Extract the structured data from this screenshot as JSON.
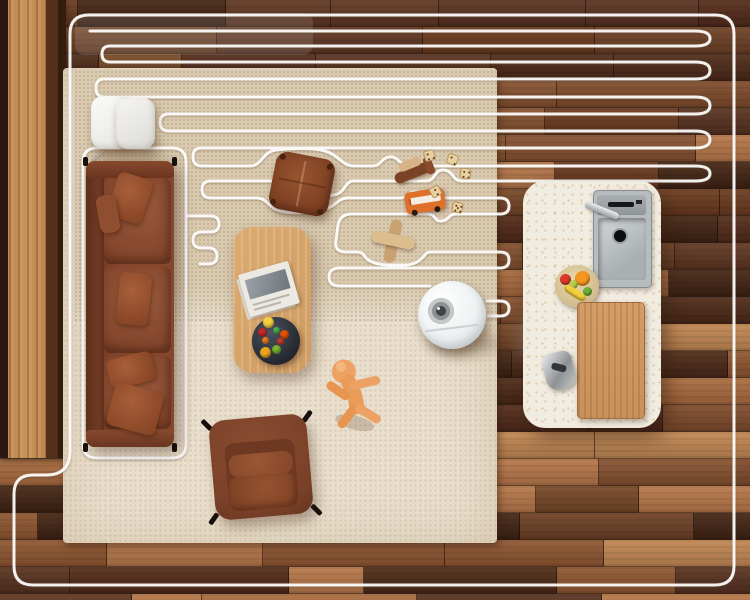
{
  "scene": {
    "type": "top-down room render",
    "description": "Robot vacuum cleaning a living room; white serpentine cleaning-path overlay covers the upper area and ends at the robot",
    "objects": [
      {
        "id": "wood-floor",
        "label": "walnut plank flooring"
      },
      {
        "id": "area-rug",
        "label": "cream area rug"
      },
      {
        "id": "inner-rug",
        "label": "beige textured rug section"
      },
      {
        "id": "cleaning-path",
        "label": "white robot cleaning path overlay"
      },
      {
        "id": "robot-vacuum",
        "label": "white robot vacuum with lidar turret"
      },
      {
        "id": "charging-dock",
        "label": "white charging dock (two units)"
      },
      {
        "id": "sofa",
        "label": "brown leather three-seat sofa with pillows"
      },
      {
        "id": "armchair",
        "label": "brown leather armchair"
      },
      {
        "id": "coffee-table",
        "label": "light wood coffee table"
      },
      {
        "id": "magazine",
        "label": "magazine on table"
      },
      {
        "id": "snack-bowl",
        "label": "dark bowl with colorful snacks"
      },
      {
        "id": "floor-pouf",
        "label": "brown leather floor cushion"
      },
      {
        "id": "kitchen-island",
        "label": "white terrazzo kitchen island"
      },
      {
        "id": "kitchen-sink",
        "label": "stainless sink with faucet"
      },
      {
        "id": "fruit-bowl",
        "label": "fruit bowl on island"
      },
      {
        "id": "cutting-board",
        "label": "wooden cutting board"
      },
      {
        "id": "utensil",
        "label": "metal kitchen utensil"
      },
      {
        "id": "toy-biplane",
        "label": "wooden toy biplane"
      },
      {
        "id": "toy-bus",
        "label": "orange toy bus"
      },
      {
        "id": "toy-plane",
        "label": "wooden toy airplane"
      },
      {
        "id": "toy-dice",
        "label": "wooden dice"
      },
      {
        "id": "toy-figure",
        "label": "orange toy figure"
      }
    ],
    "robot": {
      "center_x": 452,
      "center_y": 315,
      "diameter": 68
    },
    "dice": [
      {
        "x": 424,
        "y": 150,
        "rot": -15,
        "pips": [
          [
            3,
            3
          ],
          [
            8,
            8
          ],
          [
            3,
            8
          ]
        ]
      },
      {
        "x": 447,
        "y": 154,
        "rot": 20,
        "pips": [
          [
            3,
            3
          ],
          [
            8,
            8
          ]
        ]
      },
      {
        "x": 460,
        "y": 168,
        "rot": 8,
        "pips": [
          [
            3,
            3
          ],
          [
            8,
            3
          ],
          [
            3,
            8
          ],
          [
            8,
            8
          ]
        ]
      },
      {
        "x": 430,
        "y": 186,
        "rot": -30,
        "pips": [
          [
            5,
            3
          ],
          [
            5,
            8
          ]
        ]
      },
      {
        "x": 452,
        "y": 202,
        "rot": 12,
        "pips": [
          [
            3,
            3
          ],
          [
            8,
            3
          ],
          [
            3,
            8
          ],
          [
            8,
            8
          ],
          [
            5,
            5
          ]
        ]
      }
    ],
    "snack_colors": [
      "#d23a2a",
      "#7ab32e",
      "#e8a51e",
      "#ef7c1d",
      "#c62828",
      "#f3d03e",
      "#4caf50",
      "#e65100"
    ],
    "island_fruit": [
      {
        "x": 20,
        "y": 6,
        "w": 15,
        "h": 15,
        "c": "#f5941e"
      },
      {
        "x": 5,
        "y": 9,
        "w": 11,
        "h": 11,
        "c": "#d93b2b"
      },
      {
        "x": 28,
        "y": 22,
        "w": 9,
        "h": 9,
        "c": "#6fae3a"
      },
      {
        "x": 14,
        "y": 15,
        "w": 9,
        "h": 9,
        "c": "#b8cf4e"
      },
      {
        "x": 8,
        "y": 24,
        "w": 24,
        "h": 8,
        "c": "#f2cf3e"
      }
    ],
    "floor": {
      "row_height": 27,
      "seed": 7,
      "palette_dark": [
        "#4a2818",
        "#553020",
        "#3f2213",
        "#5c3522",
        "#50291a"
      ],
      "palette_mid": [
        "#6b3f26",
        "#744627",
        "#7d4a2c",
        "#68391f",
        "#835030"
      ],
      "palette_light": [
        "#9a5f38",
        "#a86a3f",
        "#b5764a",
        "#8d5531",
        "#c08654"
      ]
    }
  },
  "palette": {
    "path": "rgba(255,255,255,0.93)",
    "rug-outer": "#e8decb",
    "rug-inner": "#d9cab0",
    "leather": "#84462c",
    "leather-dark": "#6b3522",
    "table-wood": "#dcab72",
    "island": "#f1ece0",
    "robot-body": "#f2f4f5",
    "toy-orange": "#eda264",
    "accent-orange": "#df7029"
  }
}
